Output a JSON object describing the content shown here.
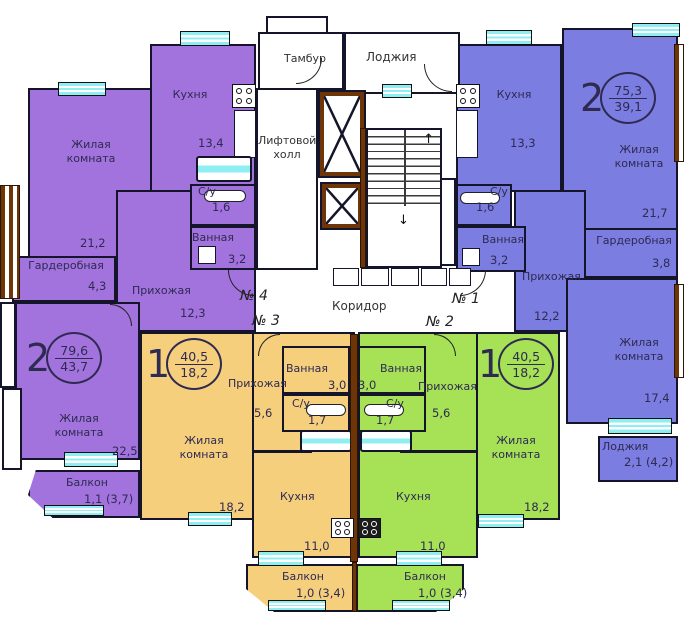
{
  "colors": {
    "purple": "#a273dc",
    "blue": "#7b7de1",
    "orange": "#f6cf7d",
    "green": "#a6e156",
    "window_cyan": "#8eeef2",
    "wood_brown": "#6e3509",
    "ink": "#2e2a52",
    "wall": "#14142a"
  },
  "common": {
    "corridor": "Коридор",
    "tambur": "Тамбур",
    "loggia": "Лоджия",
    "lift_hall": "Лифтовой холл"
  },
  "units": {
    "u1": "№ 1",
    "u2": "№ 2",
    "u3": "№ 3",
    "u4": "№ 4"
  },
  "apartments": {
    "purple": {
      "summary": {
        "rooms": "2",
        "total": "79,6",
        "living": "43,7"
      },
      "living1": {
        "label": "Жилая комната",
        "area": "21,2"
      },
      "kitchen": {
        "label": "Кухня",
        "area": "13,4"
      },
      "wardrobe": {
        "label": "Гардеробная",
        "area": "4,3"
      },
      "hallway": {
        "label": "Прихожая",
        "area": "12,3"
      },
      "su": {
        "label": "С/у",
        "area": "1,6"
      },
      "bath": {
        "label": "Ванная",
        "area": "3,2"
      },
      "living2": {
        "label": "Жилая комната",
        "area": "22,5"
      },
      "balcony": {
        "label": "Балкон",
        "area": "1,1 (3,7)"
      }
    },
    "blue": {
      "summary": {
        "rooms": "2",
        "total": "75,3",
        "living": "39,1"
      },
      "kitchen": {
        "label": "Кухня",
        "area": "13,3"
      },
      "living1": {
        "label": "Жилая комната",
        "area": "21,7"
      },
      "wardrobe": {
        "label": "Гардеробная",
        "area": "3,8"
      },
      "hallway": {
        "label": "Прихожая",
        "area": "12,2"
      },
      "su": {
        "label": "С/у",
        "area": "1,6"
      },
      "bath": {
        "label": "Ванная",
        "area": "3,2"
      },
      "living2": {
        "label": "Жилая комната",
        "area": "17,4"
      },
      "loggia": {
        "label": "Лоджия",
        "area": "2,1 (4,2)"
      }
    },
    "orange": {
      "summary": {
        "rooms": "1",
        "total": "40,5",
        "living": "18,2"
      },
      "hallway": {
        "label": "Прихожая",
        "area": "5,6"
      },
      "bath": {
        "label": "Ванная",
        "area": "3,0"
      },
      "su": {
        "label": "С/у",
        "area": "1,7"
      },
      "living": {
        "label": "Жилая комната",
        "area": "18,2"
      },
      "kitchen": {
        "label": "Кухня",
        "area": "11,0"
      },
      "balcony": {
        "label": "Балкон",
        "area": "1,0 (3,4)"
      }
    },
    "green": {
      "summary": {
        "rooms": "1",
        "total": "40,5",
        "living": "18,2"
      },
      "hallway": {
        "label": "Прихожая",
        "area": "5,6"
      },
      "bath": {
        "label": "Ванная",
        "area": "3,0"
      },
      "su": {
        "label": "С/у",
        "area": "1,7"
      },
      "living": {
        "label": "Жилая комната",
        "area": "18,2"
      },
      "kitchen": {
        "label": "Кухня",
        "area": "11,0"
      },
      "balcony": {
        "label": "Балкон",
        "area": "1,0 (3,4)"
      }
    }
  }
}
